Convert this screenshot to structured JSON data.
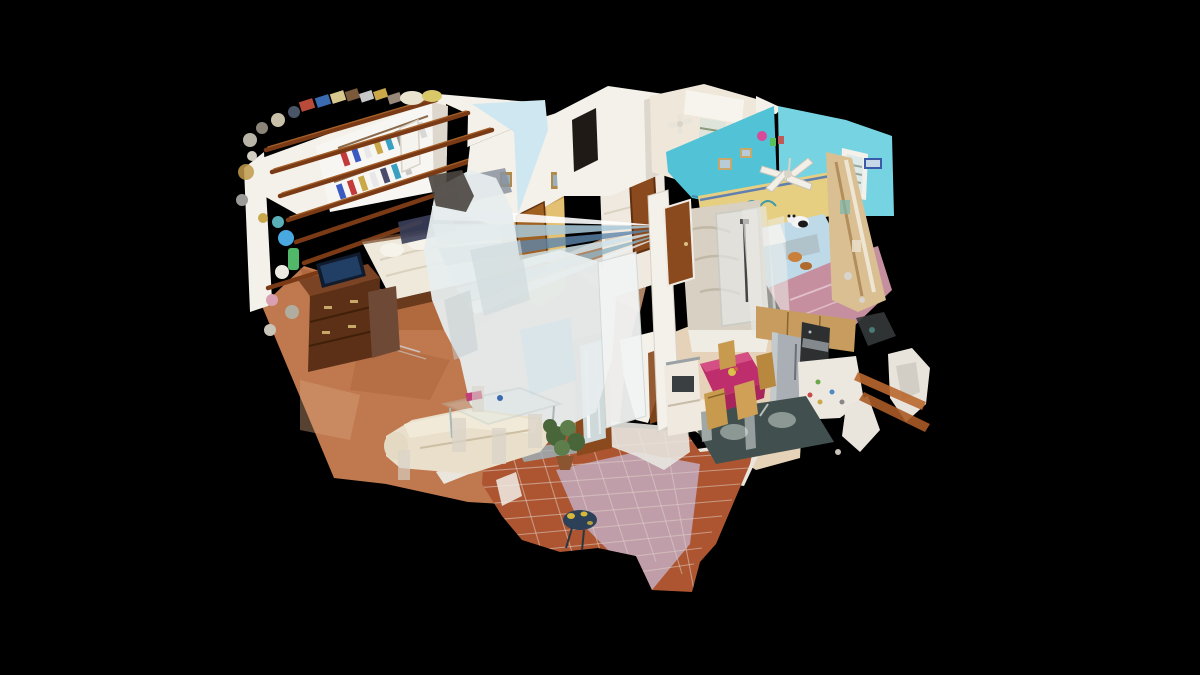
{
  "view": {
    "label": "3D dollhouse cutaway view of a scanned apartment on black background",
    "width": 1200,
    "height": 675
  },
  "scene": {
    "type": "photogrammetry-dollhouse",
    "rooms": [
      {
        "id": "master-bedroom",
        "label": "Master bedroom with wardrobe, bed, dresser and TV"
      },
      {
        "id": "living-room",
        "label": "Living room with cream sofa, glass dining table and plant"
      },
      {
        "id": "hallway",
        "label": "Central hallway with wooden doors and marble floor"
      },
      {
        "id": "top-rooms",
        "label": "Upper rooms with white walls and window with curtain"
      },
      {
        "id": "kids-bedroom",
        "label": "Turquoise children's bedroom with bed, panda plush and ceiling fan"
      },
      {
        "id": "bathroom",
        "label": "Bathroom with marble walls and glass shower"
      },
      {
        "id": "kitchen",
        "label": "Kitchen with steel fridge, oven, cabinets, sink counter and magenta dining table"
      },
      {
        "id": "terrace",
        "label": "Tiled terracotta terrace with sun-washed patch"
      },
      {
        "id": "scan-artifacts",
        "label": "Blurry mirror / glass scan artifacts and floating fragments"
      }
    ]
  },
  "colors": {
    "background": "#000000",
    "wall": "#f4f1ea",
    "wallShade": "#ddd7cd",
    "lightBlueWall": "#cfe7f0",
    "beigeWall": "#efe8da",
    "turquoise": "#52c2d6",
    "turquoiseLight": "#76d3e2",
    "yellowWall": "#e7cf82",
    "floorMarble": "#c0794f",
    "floorMarbleDeep": "#a45c32",
    "floorMarbleLight": "#d9a57d",
    "floorPink": "#c68fa0",
    "floorKitchen": "#e6d2b8",
    "terracotta": "#ad5530",
    "terraceWash": "#c0a5b4",
    "grout": "#e0d0c8",
    "woodBeam": "#7b3a16",
    "woodBeamHi": "#a35f28",
    "woodDark": "#5c3016",
    "woodMid": "#7a4324",
    "woodDoor": "#8a4a1e",
    "woodTrim": "#5f2f10",
    "cabinetWood": "#c79c5e",
    "duvet": "#efe9dc",
    "kidsBed": "#bedae8",
    "sofa": "#e9dfcb",
    "sofaBack": "#f2ead8",
    "magenta": "#bf2e6c",
    "magentaHi": "#d65588",
    "counterDark": "#41504e",
    "steel": "#93a09c",
    "fridge": "#a9afb4",
    "appliance": "#2d2f31",
    "amber": "#d9a855",
    "amberDoor": "#a06020",
    "glassBlur": "#e7edee",
    "streakBlue": "#5d86ac",
    "streakSky": "#a9c9da",
    "bathMarble": "#d8d0c2",
    "plantGreen": "#49663a",
    "plantGreenHi": "#5d7d4a",
    "toyNavy": "#2c4058",
    "toySpot": "#d8b83a",
    "ghostWhite": "#e8e6e0"
  }
}
